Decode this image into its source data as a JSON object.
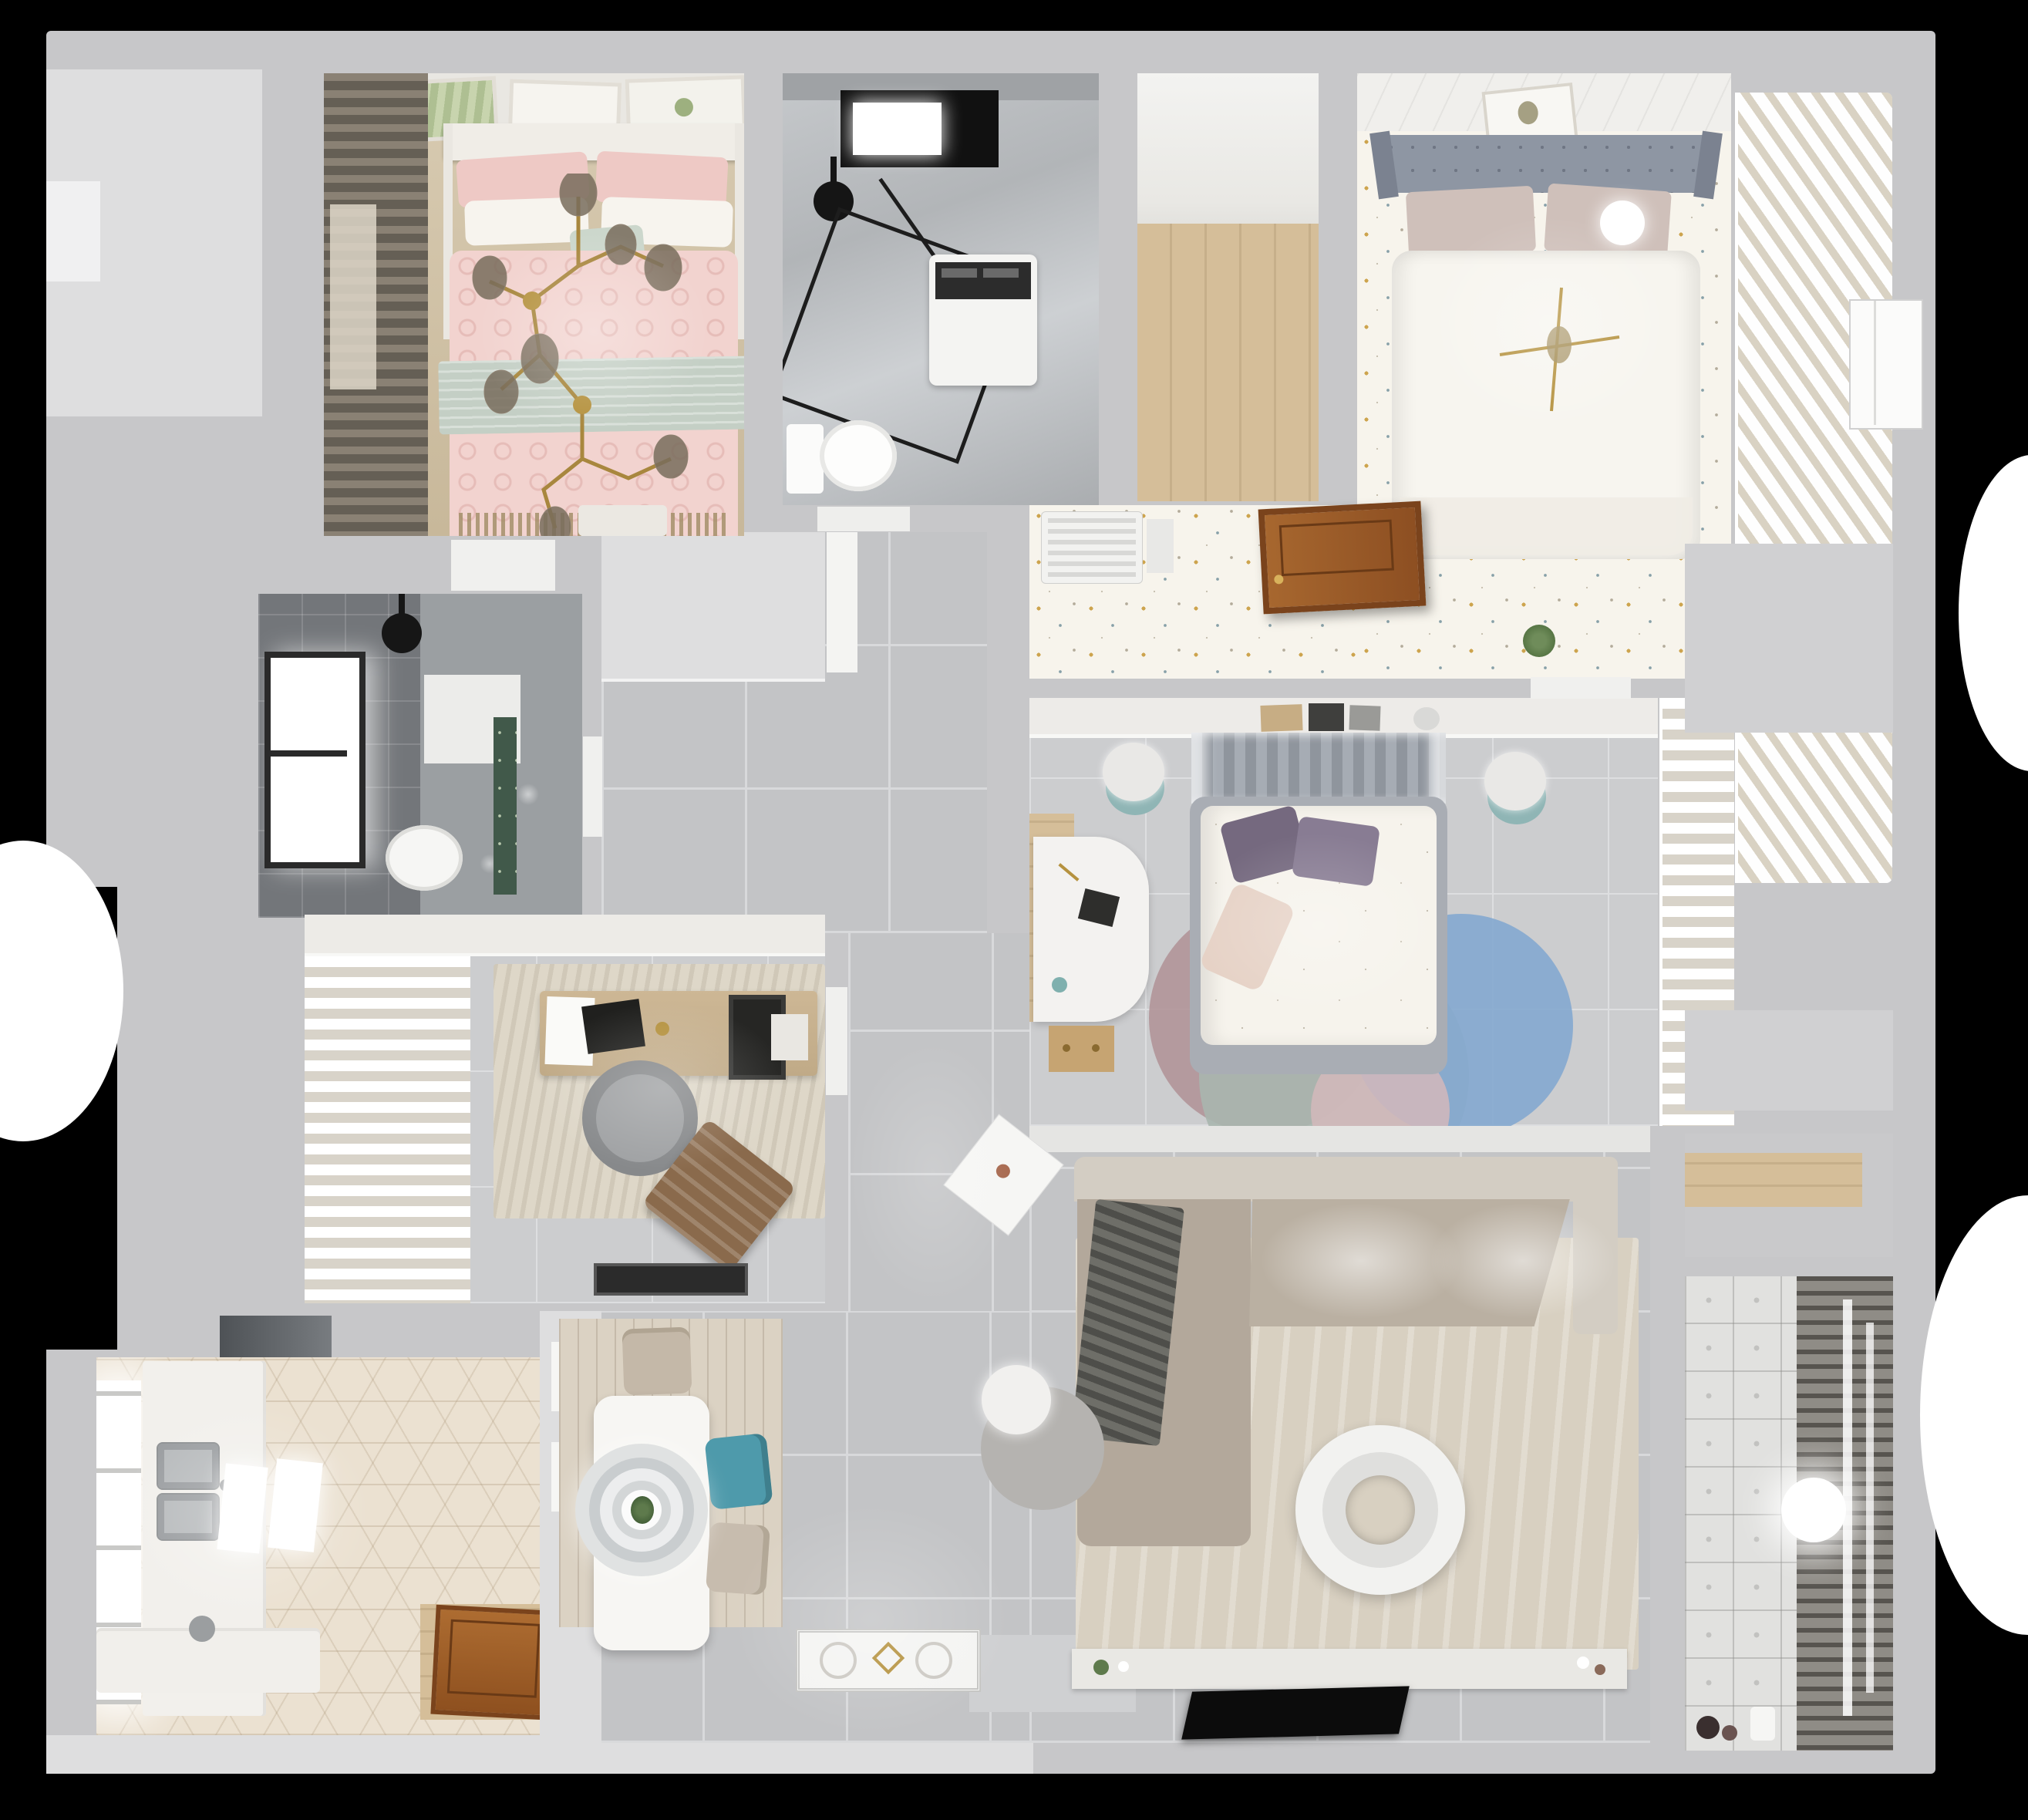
{
  "scene": {
    "type": "3d-floor-plan-top-down-render",
    "description": "Photorealistic top-down 3D render of a furnished apartment floor plan on a black background",
    "background": "#000000",
    "visible_text": "none"
  },
  "palette": {
    "wall": "#c7c7c9",
    "wallLight": "#dededf",
    "wallBright": "#f0f0f1",
    "tile": "#c3c4c6",
    "tileLine": "#d8d9db",
    "tileSmall": "#cccdcf",
    "tileSmallLine": "#dddee0",
    "darkTile": "#73767a",
    "wallpaper": "#f7f4ec",
    "dotGold": "#cda44e",
    "dotBlue": "#87a0a8",
    "dotGray": "#b3ab9a",
    "hex": "#ebe1d1",
    "woodTan": "#cdbfa5",
    "woodPlank": "#d5be99",
    "woodPlankDark": "#c6af8a",
    "pink": "#f2d3cf",
    "pinkDeep": "#eec9c5",
    "sage": "#c4cfc5",
    "slat": "#efece5",
    "slatShadow": "#d9d2c3",
    "curtainShadow": "#d8d3c9",
    "headboardGray": "#8e96a3",
    "bedBase": "#a9adb4",
    "duvetWhite": "#f6f3ec",
    "purple": "#75697f",
    "blush": "#e6d2c6",
    "teal": "#8fb5b5",
    "tealChair": "#4e9aab",
    "steel": "#b7babc",
    "hood": "#53565a",
    "doorBrown": "#a7672f",
    "doorBrownDark": "#7a431c",
    "rugBeige": "#d8d0c1",
    "sofa": "#bab0a2",
    "sofaBack": "#d3cdc3",
    "throwDark": "#4e4e4a",
    "tv": "#0c0c0c",
    "console": "#e9e8e4",
    "balcony": "#e1e1df",
    "rack": "#57544f",
    "gold": "#a8873e",
    "green": "#5d7a4b",
    "rugRose": "#b2969a",
    "rugSage": "#a9b6ae",
    "rugBlue": "#84a9cf",
    "rugPink": "#d4b9bb",
    "woodRug": "#dbd2c3"
  },
  "rooms": [
    {
      "id": "bedroom-small",
      "name": "small bedroom (pink)",
      "furniture": [
        "double-bed-pink-duvet",
        "pink-pillows",
        "white-pillows",
        "sage-throw-band",
        "gold-branch-chandelier",
        "three-wall-art-frames",
        "dark-curtains",
        "wood-floor",
        "foot-bench"
      ]
    },
    {
      "id": "bathroom-top",
      "name": "top bathroom",
      "furniture": [
        "black-framed-skylight",
        "ceiling-shower-head",
        "glass-shower-enclosure",
        "washing-machine",
        "toilet",
        "marble-floor"
      ]
    },
    {
      "id": "storage-walkin",
      "name": "walk-in storage",
      "furniture": [
        "wood-plank-floor"
      ]
    },
    {
      "id": "bedroom-top-right",
      "name": "top-right bedroom",
      "furniture": [
        "gray-tufted-headboard",
        "white-duvet-bed",
        "blush-pillows",
        "white-ball-lamp",
        "gold-branch-decor",
        "dotted-wallpaper-floor",
        "wall-art-frame",
        "ac-vent-grille",
        "open-wood-door",
        "potted-plant"
      ]
    },
    {
      "id": "wardrobe-slatted",
      "name": "slatted wardrobe strip",
      "furniture": [
        "louvered-doors"
      ]
    },
    {
      "id": "bathroom-left",
      "name": "left bathroom",
      "furniture": [
        "dark-tile-walls",
        "window",
        "ceiling-shower-head",
        "wall-niche",
        "toilet",
        "green-accent"
      ]
    },
    {
      "id": "study",
      "name": "study",
      "furniture": [
        "sheer-curtains",
        "area-rug",
        "wood-desk",
        "laptop",
        "tablet-screen",
        "paper",
        "gray-office-chair",
        "brown-lounge-chair",
        "black-door-mat",
        "white-closet-band"
      ]
    },
    {
      "id": "bedroom-master",
      "name": "master bedroom",
      "furniture": [
        "headboard-shelf-with-books",
        "canopy-curtain",
        "gray-bed-base",
        "white-floral-duvet",
        "purple-pillows",
        "blush-pillow",
        "round-stool-left",
        "round-stool-right",
        "white-desk",
        "wood-drawer-unit",
        "wood-wall-panel",
        "tri-circle-rug",
        "sheer-closet-curtains"
      ]
    },
    {
      "id": "kitchen",
      "name": "kitchen",
      "furniture": [
        "hex-tile-floor",
        "window-glow",
        "range-hood",
        "left-counter",
        "double-stainless-sink",
        "two-light-panels",
        "bottom-counter",
        "faucet",
        "open-wood-door",
        "wood-threshold"
      ]
    },
    {
      "id": "dining",
      "name": "dining area",
      "furniture": [
        "wood-strip-rug",
        "white-rectangular-table",
        "ring-pendant-light",
        "table-plant",
        "beige-chair-top",
        "teal-chair",
        "beige-chair-bottom",
        "shelf-partition"
      ]
    },
    {
      "id": "living",
      "name": "living room",
      "furniture": [
        "l-shaped-beige-sofa",
        "dark-throw-blanket",
        "white-side-table",
        "gray-ottoman-with-white-seat",
        "round-white-coffee-table",
        "large-beige-rug",
        "tv-console",
        "black-tv",
        "entry-mat",
        "entry-tile"
      ]
    },
    {
      "id": "balcony",
      "name": "balcony / laundry",
      "furniture": [
        "patterned-tile-floor",
        "louvered-drying-rack",
        "white-ball-pendant",
        "wood-shelf-niche",
        "small-toys",
        "watering-can"
      ]
    },
    {
      "id": "hall-right",
      "name": "right hall",
      "furniture": [
        "white-door",
        "wall-recesses"
      ]
    },
    {
      "id": "corridor",
      "name": "corridor",
      "furniture": [
        "large-gray-floor-tiles",
        "white-wall-block"
      ]
    }
  ]
}
